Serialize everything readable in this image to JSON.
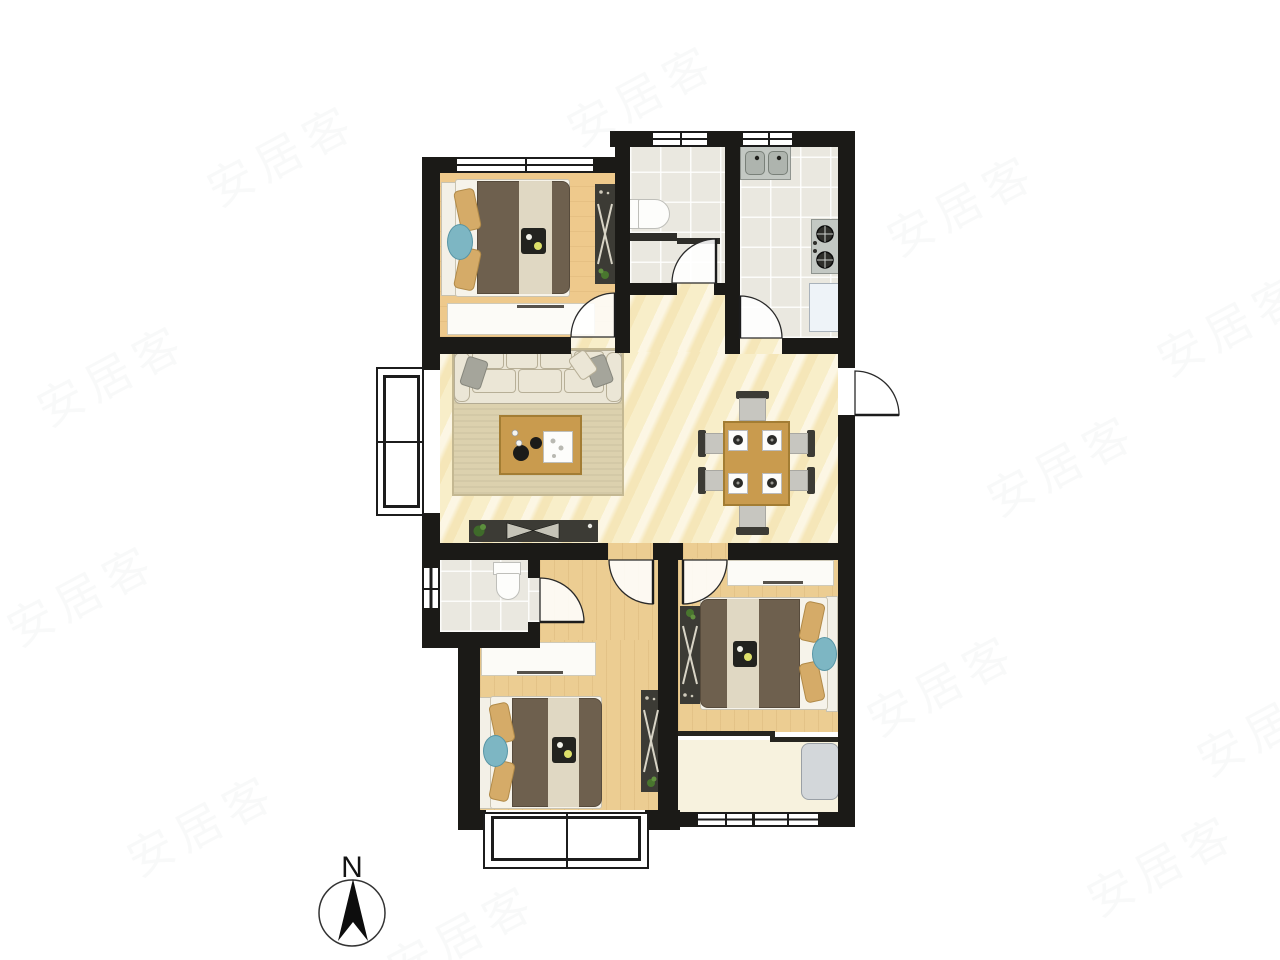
{
  "meta": {
    "type": "apartment-floor-plan",
    "compass_label": "N"
  },
  "palette": {
    "wall": "#1b1a17",
    "line": "#1c1c1c",
    "wood1": "#eec98c",
    "wood2": "#eccd92",
    "marble": "#f8eec9",
    "tile": "#eae8e0",
    "cream": "#f7f2de",
    "rug": "#dcd1ae",
    "sofa": "#ebe6d6",
    "furn_white": "#fcfbf7",
    "table_wood": "#c99b4e",
    "dark_furn": "#3c3b35",
    "blanket": "#6e604e",
    "stripe": "#e8e1cc",
    "pillow": "#d5ab68",
    "blue": "#7db6c3",
    "chair_seat": "#c7c6c0",
    "appliance": "#c3c8c3",
    "washer": "#d3d7da"
  },
  "rooms": [
    {
      "id": "bedroom-top-left",
      "floor": "wood",
      "furniture": [
        "double-bed",
        "wardrobe",
        "dresser"
      ]
    },
    {
      "id": "bathroom-top",
      "floor": "tile",
      "furniture": [
        "toilet",
        "shower-partition"
      ]
    },
    {
      "id": "kitchen",
      "floor": "tile",
      "furniture": [
        "double-sink",
        "gas-stove",
        "fridge"
      ]
    },
    {
      "id": "living-room",
      "floor": "marble",
      "furniture": [
        "sofa",
        "rug",
        "coffee-table",
        "tv-cabinet"
      ]
    },
    {
      "id": "dining-area",
      "floor": "marble",
      "furniture": [
        "dining-table",
        "chairs",
        "placemats"
      ]
    },
    {
      "id": "bathroom-bottom",
      "floor": "tile",
      "furniture": [
        "toilet"
      ]
    },
    {
      "id": "bedroom-bottom-middle",
      "floor": "wood",
      "furniture": [
        "double-bed",
        "wardrobe",
        "desk"
      ]
    },
    {
      "id": "bedroom-bottom-right",
      "floor": "wood",
      "furniture": [
        "double-bed",
        "wardrobe",
        "desk"
      ]
    },
    {
      "id": "balcony",
      "floor": "cream",
      "furniture": [
        "washing-machine"
      ]
    }
  ],
  "compass": {
    "label": "N",
    "direction": "up"
  },
  "watermark": {
    "text": "安居客",
    "opacity": 0.045,
    "positions": [
      [
        30,
        340
      ],
      [
        0,
        560
      ],
      [
        120,
        790
      ],
      [
        880,
        170
      ],
      [
        980,
        430
      ],
      [
        860,
        650
      ],
      [
        1080,
        830
      ],
      [
        560,
        60
      ],
      [
        380,
        900
      ],
      [
        1150,
        290
      ],
      [
        200,
        120
      ],
      [
        1190,
        690
      ]
    ]
  }
}
